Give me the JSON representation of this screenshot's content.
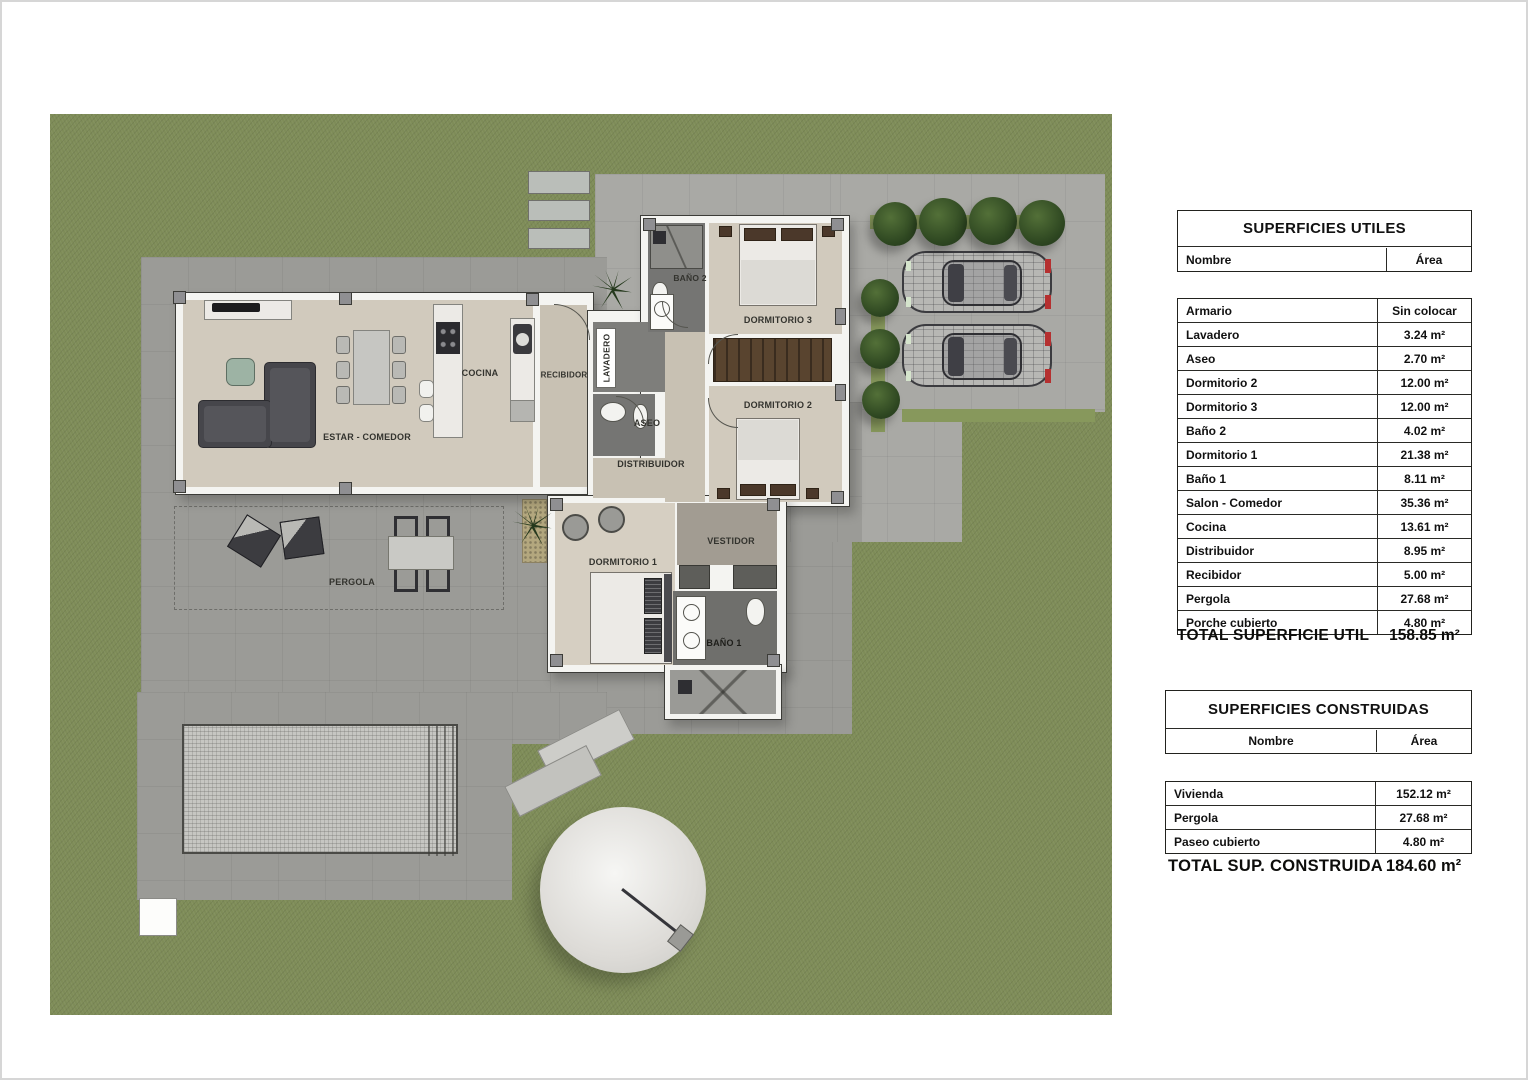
{
  "plan": {
    "labels": {
      "estar_comedor": "ESTAR - COMEDOR",
      "cocina": "COCINA",
      "recibidor": "RECIBIDOR",
      "lavadero": "LAVADERO",
      "aseo": "ASEO",
      "distribuidor": "DISTRIBUIDOR",
      "bano2": "BAÑO 2",
      "dormitorio3": "DORMITORIO 3",
      "dormitorio2": "DORMITORIO 2",
      "dormitorio1": "DORMITORIO 1",
      "vestidor": "VESTIDOR",
      "bano1": "BAÑO 1",
      "pergola": "PERGOLA"
    },
    "colors": {
      "lawn": "#7e8c58",
      "paving": "#9b9b97",
      "driveway": "#a9a9a5",
      "floor": "#d1cabd",
      "bath_floor": "#757573",
      "wall": "#f4f4f1",
      "tree": "#2e4721",
      "hedge": "#87985c",
      "wardrobe": "#59442f"
    }
  },
  "tables": {
    "utiles": {
      "title": "SUPERFICIES UTILES",
      "col_name": "Nombre",
      "col_area": "Área",
      "rows": [
        {
          "name": "Armario",
          "area": "Sin colocar"
        },
        {
          "name": "Lavadero",
          "area": "3.24 m²"
        },
        {
          "name": "Aseo",
          "area": "2.70 m²"
        },
        {
          "name": "Dormitorio 2",
          "area": "12.00 m²"
        },
        {
          "name": "Dormitorio 3",
          "area": "12.00 m²"
        },
        {
          "name": "Baño 2",
          "area": "4.02 m²"
        },
        {
          "name": "Dormitorio 1",
          "area": "21.38 m²"
        },
        {
          "name": "Baño 1",
          "area": "8.11 m²"
        },
        {
          "name": "Salon - Comedor",
          "area": "35.36 m²"
        },
        {
          "name": "Cocina",
          "area": "13.61 m²"
        },
        {
          "name": "Distribuidor",
          "area": "8.95 m²"
        },
        {
          "name": "Recibidor",
          "area": "5.00 m²"
        },
        {
          "name": "Pergola",
          "area": "27.68 m²"
        },
        {
          "name": "Porche cubierto",
          "area": "4.80 m²"
        }
      ],
      "total_label": "TOTAL SUPERFICIE UTIL",
      "total_value": "158.85 m²"
    },
    "construidas": {
      "title": "SUPERFICIES CONSTRUIDAS",
      "col_name": "Nombre",
      "col_area": "Área",
      "rows": [
        {
          "name": "Vivienda",
          "area": "152.12 m²"
        },
        {
          "name": "Pergola",
          "area": "27.68 m²"
        },
        {
          "name": "Paseo cubierto",
          "area": "4.80 m²"
        }
      ],
      "total_label": "TOTAL SUP. CONSTRUIDA",
      "total_value": "184.60 m²"
    }
  }
}
